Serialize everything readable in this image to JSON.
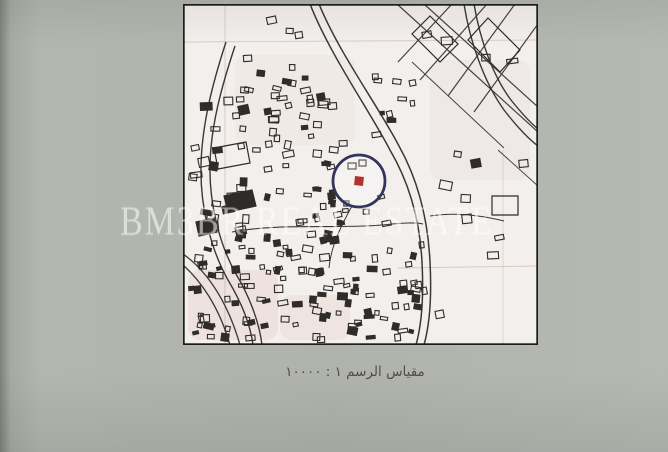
{
  "photo": {
    "background_color": "#b1b4ad",
    "paper_color": "#f2efec",
    "frame_color": "#1d1d1b"
  },
  "watermark": {
    "text": "BM3BR REAL ESTATE",
    "color": "rgba(255,255,255,0.55)"
  },
  "caption": {
    "text": "مقياس الرسم ١ : ١٠٠٠٠",
    "color": "#534d47"
  },
  "map": {
    "frame": {
      "x": 183,
      "y": 4,
      "width": 355,
      "height": 341,
      "border_width": 3.4
    },
    "marker": {
      "cx": 359,
      "cy": 181,
      "r": 26,
      "ring_color": "#33345a",
      "ring_width": 2.8,
      "dot_color": "#b2322e",
      "dot_size": 9
    },
    "grid": {
      "color": "#c2a59d",
      "lines": [
        {
          "x1": 225,
          "y1": 4,
          "x2": 225,
          "y2": 345,
          "o": 0.55
        },
        {
          "x1": 183,
          "y1": 42,
          "x2": 538,
          "y2": 40,
          "o": 0.5
        },
        {
          "x1": 398,
          "y1": 268,
          "x2": 538,
          "y2": 266,
          "o": 0.55
        },
        {
          "x1": 503,
          "y1": 150,
          "x2": 503,
          "y2": 345,
          "o": 0.4
        }
      ]
    },
    "roads": {
      "color": "#3a3836",
      "paths": [
        {
          "d": "M310,4 C330,55 368,108 390,150 C410,184 420,222 422,262 C424,300 421,327 416,345",
          "w": 1.5
        },
        {
          "d": "M319,4 C339,53 377,104 399,146 C418,180 428,220 430,262 C432,300 429,327 424,345",
          "w": 1.5
        },
        {
          "d": "M464,4 C470,42 484,82 504,110 C518,128 530,140 538,146",
          "w": 1.4
        },
        {
          "d": "M474,4 C480,40 493,76 511,100 C523,115 532,124 538,129",
          "w": 1.4
        },
        {
          "d": "M226,42 C212,85 202,125 201,165 C200,205 210,248 228,280 C240,300 250,322 253,345",
          "w": 1.4
        },
        {
          "d": "M235,46 C221,88 211,126 210,164 C209,202 219,244 236,274 C248,294 259,320 262,345",
          "w": 1.4
        },
        {
          "d": "M183,254 C203,268 226,296 240,345",
          "w": 1.3
        },
        {
          "d": "M183,265 C200,280 219,306 230,345",
          "w": 1.3
        },
        {
          "d": "M232,232 C280,223 332,229 382,225 C402,223 416,222 423,224",
          "w": 1.1
        },
        {
          "d": "M430,216 C455,212 480,215 504,221",
          "w": 1.0
        },
        {
          "d": "M352,206 C341,226 331,246 329,268",
          "w": 1.0
        }
      ]
    },
    "streets": {
      "color": "#45413e",
      "paths": [
        {
          "d": "M397,4 L538,132",
          "w": 1.2
        },
        {
          "d": "M424,4 L538,107",
          "w": 1.2
        },
        {
          "d": "M452,4 L398,62",
          "w": 1.2
        },
        {
          "d": "M487,4 L420,80",
          "w": 1.2
        },
        {
          "d": "M515,4 L448,96",
          "w": 1.2
        },
        {
          "d": "M538,24 L474,112",
          "w": 1.2
        },
        {
          "d": "M412,62 L504,148",
          "w": 1.0
        },
        {
          "d": "M498,150 L538,186",
          "w": 1.0
        }
      ]
    },
    "shapes": {
      "color": "#2e2b29",
      "items": [
        {
          "d": "M488,18 L520,50 L500,72 L468,40 Z",
          "solid": false
        },
        {
          "d": "M430,16 L458,44 L440,62 L412,34 Z",
          "solid": false
        },
        {
          "d": "M492,196 L518,196 L518,215 L492,215 Z",
          "solid": false
        },
        {
          "d": "M214,148 L246,142 L250,163 L218,169 Z",
          "solid": false
        },
        {
          "d": "M224,196 L252,190 L256,206 L228,212 Z",
          "solid": true
        },
        {
          "d": "M196,222 L214,218 L217,232 L199,236 Z",
          "solid": true
        },
        {
          "d": "M348,163 L356,163 L356,169 L348,169 Z",
          "solid": false
        },
        {
          "d": "M359,160 L366,160 L366,166 L359,166 Z",
          "solid": false
        }
      ]
    },
    "blotches": [
      {
        "x": 188,
        "y": 270,
        "w": 90,
        "h": 70,
        "fill": "rgba(214,168,158,0.18)"
      },
      {
        "x": 280,
        "y": 295,
        "w": 70,
        "h": 45,
        "fill": "rgba(214,168,158,0.15)"
      },
      {
        "x": 235,
        "y": 55,
        "w": 120,
        "h": 90,
        "fill": "rgba(222,196,186,0.12)"
      },
      {
        "x": 430,
        "y": 60,
        "w": 100,
        "h": 120,
        "fill": "rgba(210,190,180,0.10)"
      }
    ],
    "building_color": "#2f2c2a",
    "clusters": [
      {
        "x": 232,
        "y": 14,
        "w": 100,
        "h": 118,
        "count": 20,
        "min": 5,
        "max": 10,
        "solid_ratio": 0.15,
        "seed": 11
      },
      {
        "x": 252,
        "y": 92,
        "w": 95,
        "h": 95,
        "count": 22,
        "min": 5,
        "max": 11,
        "solid_ratio": 0.2,
        "seed": 22
      },
      {
        "x": 186,
        "y": 95,
        "w": 70,
        "h": 140,
        "count": 24,
        "min": 5,
        "max": 12,
        "solid_ratio": 0.45,
        "seed": 33
      },
      {
        "x": 300,
        "y": 140,
        "w": 55,
        "h": 70,
        "count": 8,
        "min": 4,
        "max": 8,
        "solid_ratio": 0.2,
        "seed": 44
      },
      {
        "x": 228,
        "y": 228,
        "w": 200,
        "h": 115,
        "count": 95,
        "min": 4,
        "max": 10,
        "solid_ratio": 0.4,
        "seed": 55
      },
      {
        "x": 186,
        "y": 240,
        "w": 60,
        "h": 103,
        "count": 26,
        "min": 4,
        "max": 10,
        "solid_ratio": 0.45,
        "seed": 66
      },
      {
        "x": 435,
        "y": 150,
        "w": 95,
        "h": 180,
        "count": 9,
        "min": 6,
        "max": 13,
        "solid_ratio": 0.1,
        "seed": 77
      },
      {
        "x": 398,
        "y": 12,
        "w": 120,
        "h": 75,
        "count": 5,
        "min": 6,
        "max": 12,
        "solid_ratio": 0.1,
        "seed": 88
      },
      {
        "x": 360,
        "y": 60,
        "w": 55,
        "h": 80,
        "count": 10,
        "min": 4,
        "max": 9,
        "solid_ratio": 0.2,
        "seed": 99
      },
      {
        "x": 255,
        "y": 185,
        "w": 150,
        "h": 42,
        "count": 18,
        "min": 4,
        "max": 9,
        "solid_ratio": 0.3,
        "seed": 12
      }
    ]
  }
}
